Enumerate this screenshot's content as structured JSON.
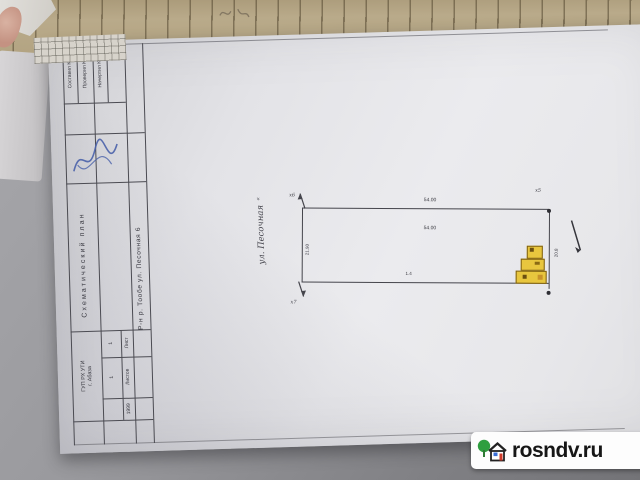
{
  "watermark": {
    "site": "rosndv.ru"
  },
  "stamp": {
    "doc_type": "Схематический план",
    "address": "Р-н р. Тообе ул. Песочная 6",
    "org_line1": "ГУП РХ УТИ",
    "org_line2": "г. Абаза",
    "rows": [
      {
        "label": "Составил К."
      },
      {
        "label": "Проверил К."
      },
      {
        "label": "Начертил К."
      }
    ],
    "sheet_label": "Лист",
    "sheet_value": "1",
    "sheets_label": "Листов",
    "sheets_value": "1",
    "bottom_number": "1999"
  },
  "plan": {
    "street_quote": "«",
    "street_label": "ул. Песочная",
    "dim_top": "54.00",
    "dim_mid": "54.00",
    "dim_left": "21.90",
    "dim_bottom": "1.4",
    "dim_right": "20.8",
    "corner_mark_top": "х6",
    "corner_mark_bottom": "х7",
    "corner_mark_right": "х5"
  },
  "colors": {
    "building_fill": "#e8c63e",
    "signature_ink": "#4a62aa",
    "paper": "#e9e9ec",
    "backing_paper": "#b2a483"
  }
}
